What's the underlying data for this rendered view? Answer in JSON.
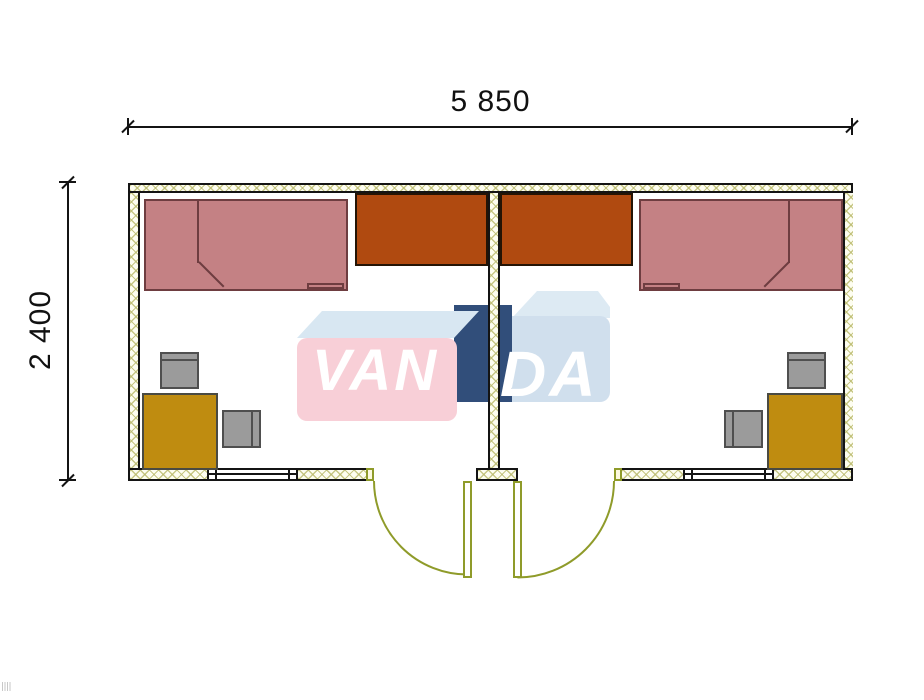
{
  "plan": {
    "brand": "VANDA",
    "watermark_left": "VAN",
    "watermark_right": "DA",
    "width_label": "5 850",
    "height_label": "2 400"
  },
  "colors": {
    "outline": "#141414",
    "bed": "#c48184",
    "bed_border": "#6e3d40",
    "wardrobe": "#b04a10",
    "desk": "#bf8c10",
    "chair": "#9b9b9b",
    "door": "#8f9b2a",
    "watermark_pink": "#f8ccd4",
    "watermark_blue": "#cdddec",
    "watermark_navy": "#20406f",
    "watermark_topface": "#d5e6f1"
  },
  "rooms": [
    {
      "id": "left",
      "furniture": [
        "single-bed",
        "wardrobe",
        "desk",
        "chair",
        "chair"
      ],
      "openings": [
        "window",
        "outward-swing-door"
      ]
    },
    {
      "id": "right",
      "furniture": [
        "single-bed",
        "wardrobe",
        "desk",
        "chair",
        "chair"
      ],
      "openings": [
        "window",
        "outward-swing-door"
      ]
    }
  ]
}
